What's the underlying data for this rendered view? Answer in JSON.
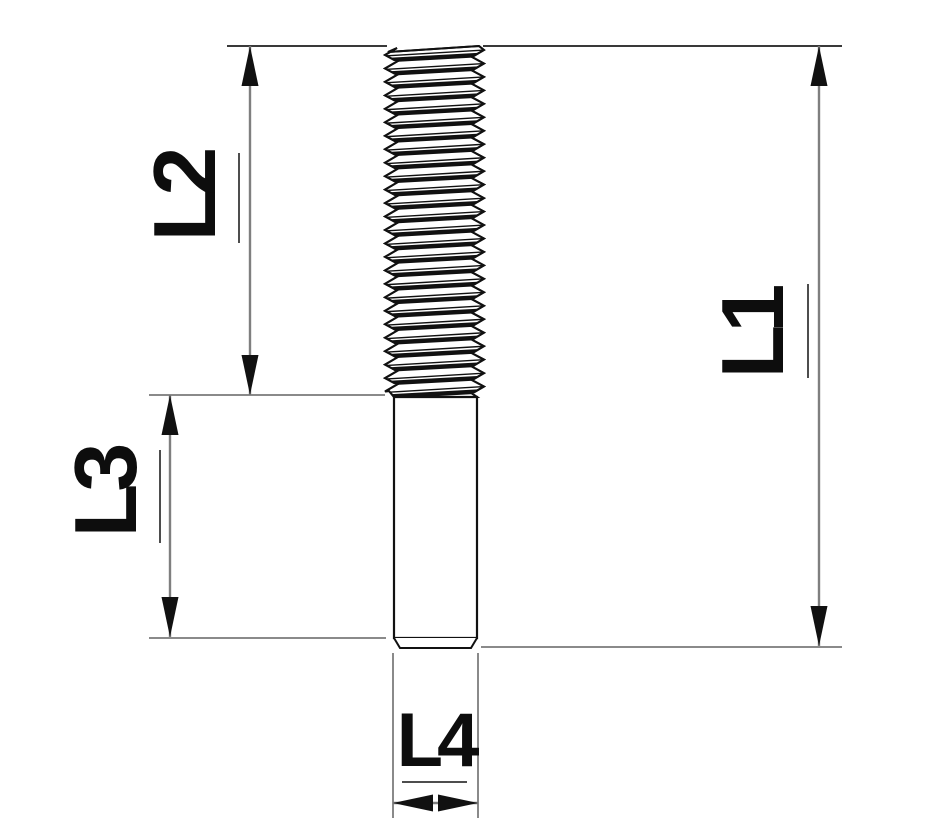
{
  "drawing": {
    "kind": "technical-dimension-drawing",
    "part": "threaded-stud",
    "labels": {
      "l1": "L1",
      "l2": "L2",
      "l3": "L3",
      "l4": "L4"
    },
    "colors": {
      "background": "#ffffff",
      "outline": "#111111",
      "dimension_line": "#7f7f7f",
      "extension_line": "#8a8a8a",
      "extension_line_dark": "#1d1d1d",
      "arrowhead": "#111111",
      "label_text": "#0d0d0d",
      "underline": "#4d4d4d"
    }
  }
}
